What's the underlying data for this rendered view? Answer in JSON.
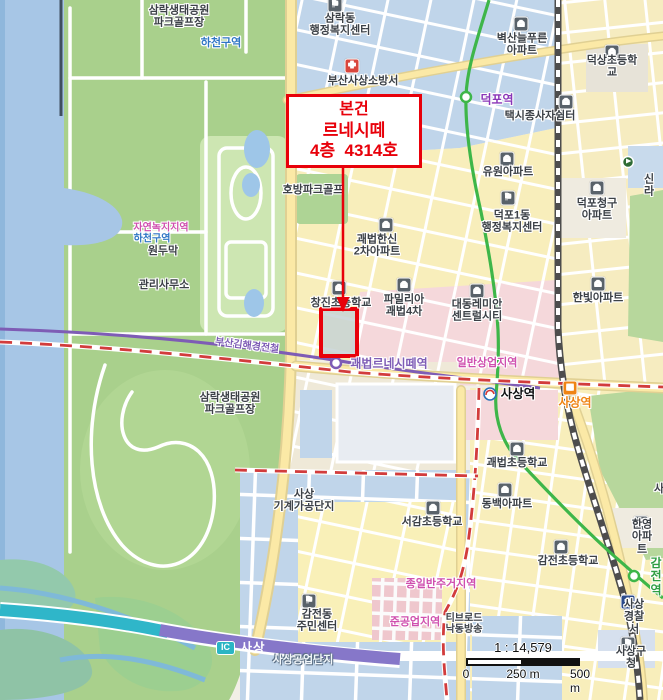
{
  "callout": {
    "line1": "본건",
    "line2": "르네시떼",
    "line3": "4층  4314호"
  },
  "scalebar": {
    "ratio": "1 : 14,579",
    "zero": "0",
    "mid": "250 m",
    "end": "500 m"
  },
  "colors": {
    "highlight_red": "#e8000a",
    "metro_line2_green": "#3eb649",
    "light_rail_purple": "#7e5cb5",
    "expressway_purple": "#8677c9",
    "boundary_red": "#d23c3c"
  },
  "map": {
    "ic_badge": "IC",
    "labels": [
      {
        "n": "label-park-name-top",
        "t": "삼락생태공원\n파크골프장",
        "x": 179,
        "y": 17
      },
      {
        "n": "label-river-zone-top",
        "t": "하천구역",
        "x": 221,
        "y": 43,
        "c": "blue"
      },
      {
        "n": "samnak-center-icon",
        "ic": "gov",
        "x": 335,
        "y": 5
      },
      {
        "n": "label-samnakdong-center",
        "t": "삼락동\n행정복지센터",
        "x": 340,
        "y": 25
      },
      {
        "n": "fire-station-icon",
        "ic": "fire",
        "x": 352,
        "y": 66
      },
      {
        "n": "label-fire-station",
        "t": "부산사상소방서",
        "x": 363,
        "y": 81
      },
      {
        "n": "apartment-icon",
        "ic": "apt",
        "x": 521,
        "y": 24
      },
      {
        "n": "label-byeoksan-apt",
        "t": "벽산늘푸른\n아파트",
        "x": 522,
        "y": 45
      },
      {
        "n": "school-icon",
        "ic": "school",
        "x": 612,
        "y": 52
      },
      {
        "n": "label-deoksang-school",
        "t": "덕상초등학교",
        "x": 612,
        "y": 67
      },
      {
        "n": "label-deokpo-station",
        "t": "덕포역",
        "x": 497,
        "y": 100,
        "c": "purple"
      },
      {
        "n": "taxi-shelter-icon",
        "ic": "taxi",
        "x": 566,
        "y": 102
      },
      {
        "n": "label-taxi-shelter",
        "t": "택시종사자쉼터",
        "x": 540,
        "y": 116
      },
      {
        "n": "apartment-icon",
        "ic": "apt",
        "x": 507,
        "y": 159
      },
      {
        "n": "label-yuwon-apt",
        "t": "유원아파트",
        "x": 508,
        "y": 172
      },
      {
        "n": "label-silla",
        "t": "신라",
        "x": 649,
        "y": 186
      },
      {
        "n": "apartment-icon",
        "ic": "apt",
        "x": 597,
        "y": 188
      },
      {
        "n": "label-cheonggu-apt",
        "t": "덕포청구\n아파트",
        "x": 597,
        "y": 210
      },
      {
        "n": "gov-icon",
        "ic": "gov",
        "x": 508,
        "y": 198
      },
      {
        "n": "label-deokpo1dong-center",
        "t": "덕포1동\n행정복지센터",
        "x": 512,
        "y": 222
      },
      {
        "n": "apartment-icon",
        "ic": "apt",
        "x": 598,
        "y": 284
      },
      {
        "n": "label-hanbit-apt",
        "t": "한빛아파트",
        "x": 598,
        "y": 298
      },
      {
        "n": "label-hobang-golf",
        "t": "호방파크골프",
        "x": 313,
        "y": 190
      },
      {
        "n": "apartment-icon",
        "ic": "apt",
        "x": 386,
        "y": 225
      },
      {
        "n": "label-hanshin-apt",
        "t": "괘법한신\n2차아파트",
        "x": 377,
        "y": 246
      },
      {
        "n": "apartment-icon",
        "ic": "apt",
        "x": 404,
        "y": 285
      },
      {
        "n": "label-familia-apt",
        "t": "파밀리아\n괘법4차",
        "x": 404,
        "y": 306
      },
      {
        "n": "apartment-icon",
        "ic": "apt",
        "x": 477,
        "y": 291
      },
      {
        "n": "label-daedong-apt",
        "t": "대동레미안\n센트럴시티",
        "x": 477,
        "y": 311
      },
      {
        "n": "label-nature-green-zone",
        "t": "자연녹지지역",
        "x": 161,
        "y": 228,
        "c": "mag sm"
      },
      {
        "n": "label-river-zone-left",
        "t": "하천구역",
        "x": 152,
        "y": 239,
        "c": "blue sm"
      },
      {
        "n": "label-wondumak",
        "t": "원두막",
        "x": 163,
        "y": 251
      },
      {
        "n": "label-park-office",
        "t": "관리사무소",
        "x": 164,
        "y": 285
      },
      {
        "n": "school-icon",
        "ic": "school",
        "x": 339,
        "y": 288
      },
      {
        "n": "label-changjin-school",
        "t": "창진초등학교",
        "x": 341,
        "y": 303
      },
      {
        "n": "label-bgl-line",
        "t": "부산김해경전철",
        "x": 247,
        "y": 346,
        "c": "lrail sm",
        "rot": 7
      },
      {
        "n": "label-renecite-station",
        "t": "괘법르네시떼역",
        "x": 389,
        "y": 364,
        "c": "lrail bold12"
      },
      {
        "n": "label-commercial-zone",
        "t": "일반상업지역",
        "x": 487,
        "y": 363,
        "c": "mag"
      },
      {
        "n": "label-sasang-metro-station",
        "t": "사상역",
        "x": 518,
        "y": 394,
        "c": "blk"
      },
      {
        "n": "ktx-station-icon",
        "ic": "ktx",
        "x": 570,
        "y": 388
      },
      {
        "n": "label-sasang-ktx-station",
        "t": "사상역",
        "x": 575,
        "y": 403,
        "c": "org"
      },
      {
        "n": "label-park-name-lower",
        "t": "삼락생태공원\n파크골프장",
        "x": 230,
        "y": 404
      },
      {
        "n": "label-machine-complex",
        "t": "사상\n기계가공단지",
        "x": 304,
        "y": 501
      },
      {
        "n": "school-icon",
        "ic": "school",
        "x": 433,
        "y": 508
      },
      {
        "n": "label-seogam-school",
        "t": "서감초등학교",
        "x": 432,
        "y": 522
      },
      {
        "n": "school-icon",
        "ic": "school",
        "x": 517,
        "y": 449
      },
      {
        "n": "label-gwaebeop-school",
        "t": "괘법초등학교",
        "x": 517,
        "y": 463
      },
      {
        "n": "apartment-icon",
        "ic": "apt",
        "x": 505,
        "y": 490
      },
      {
        "n": "label-dongbaek-apt",
        "t": "동백아파트",
        "x": 507,
        "y": 504
      },
      {
        "n": "apartment-icon",
        "ic": "apt",
        "x": 641,
        "y": 523
      },
      {
        "n": "label-hanyoung-apt",
        "t": "한영아파트",
        "x": 642,
        "y": 537
      },
      {
        "n": "label-sasang-cut",
        "t": "사",
        "x": 659,
        "y": 489
      },
      {
        "n": "school-icon",
        "ic": "school",
        "x": 561,
        "y": 547
      },
      {
        "n": "label-gamjeon-school",
        "t": "감전초등학교",
        "x": 568,
        "y": 561
      },
      {
        "n": "gov-icon",
        "ic": "gov",
        "x": 309,
        "y": 601
      },
      {
        "n": "label-gamjeondong-center",
        "t": "감전동\n주민센터",
        "x": 317,
        "y": 621
      },
      {
        "n": "label-residential-zone",
        "t": "종일반주거지역",
        "x": 441,
        "y": 584,
        "c": "mag"
      },
      {
        "n": "label-semi-industrial-zone",
        "t": "준공업지역",
        "x": 415,
        "y": 622,
        "c": "mag"
      },
      {
        "n": "label-tbroad",
        "t": "티브로드\n낙동방송",
        "x": 464,
        "y": 624,
        "c": "sm"
      },
      {
        "n": "label-industrial-complex",
        "t": "사상공업단지",
        "x": 303,
        "y": 660,
        "c": "wt"
      },
      {
        "n": "police-icon",
        "ic": "police",
        "x": 628,
        "y": 602
      },
      {
        "n": "label-police-station",
        "t": "사상경찰서",
        "x": 634,
        "y": 617
      },
      {
        "n": "gov-icon",
        "ic": "gov",
        "x": 628,
        "y": 644
      },
      {
        "n": "label-gu-office",
        "t": "사상구청",
        "x": 631,
        "y": 658
      },
      {
        "n": "label-gamjeon-station",
        "t": "감전역",
        "x": 656,
        "y": 577,
        "c": "grn"
      },
      {
        "n": "label-ic-sasang-road",
        "t": "사상",
        "x": 253,
        "y": 648,
        "c": "icroad"
      }
    ]
  }
}
